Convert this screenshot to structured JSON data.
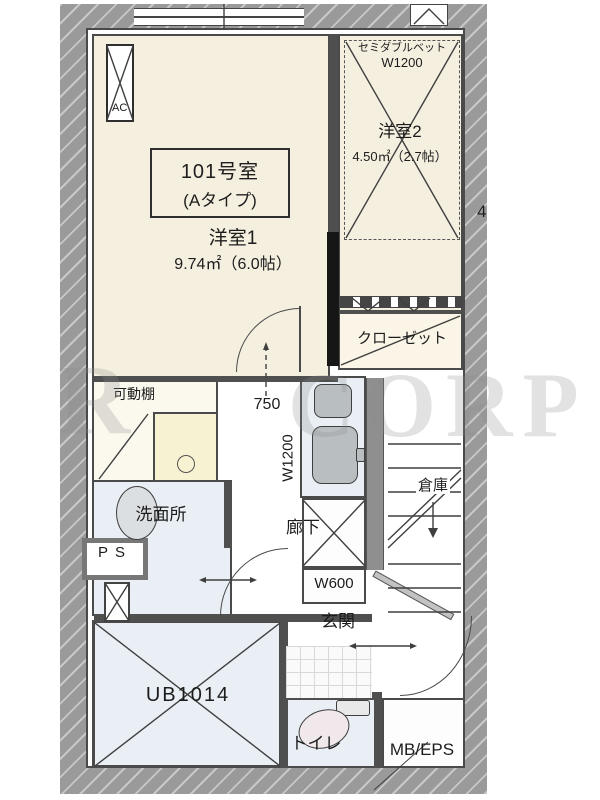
{
  "unit_label": {
    "number": "101号室",
    "type": "(Aタイプ)"
  },
  "rooms": {
    "room1": {
      "name": "洋室1",
      "area": "9.74㎡（6.0帖）"
    },
    "room2": {
      "name": "洋室2",
      "area": "4.50㎡（2.7帖）"
    },
    "closet": {
      "name": "クローゼット"
    },
    "shelf": {
      "name": "可動棚"
    },
    "washroom": {
      "name": "洗面所"
    },
    "corridor": {
      "name": "廊下"
    },
    "storage": {
      "name": "倉庫"
    },
    "entrance": {
      "name": "玄関"
    },
    "bath": {
      "name": "UB1014"
    },
    "toilet": {
      "name": "トイレ"
    },
    "mb_eps": {
      "name": "MB/EPS"
    },
    "pipe_space": {
      "name": "PS"
    },
    "ac": {
      "name": "AC"
    }
  },
  "fixtures": {
    "bed": {
      "label": "セミダブルベット",
      "width": "W1200"
    }
  },
  "dimensions": {
    "kitchen": "W1200",
    "shoe_box": "W600",
    "door": "750",
    "edge_number": "4"
  },
  "watermark": {
    "left": "R",
    "right": "CORP"
  },
  "colors": {
    "room_floor": "#f5efdf",
    "wet_area_floor": "#e9eff5",
    "laundry_floor": "#f7f3d2",
    "wall": "#9a9a9a",
    "line": "#3f3f3f"
  }
}
